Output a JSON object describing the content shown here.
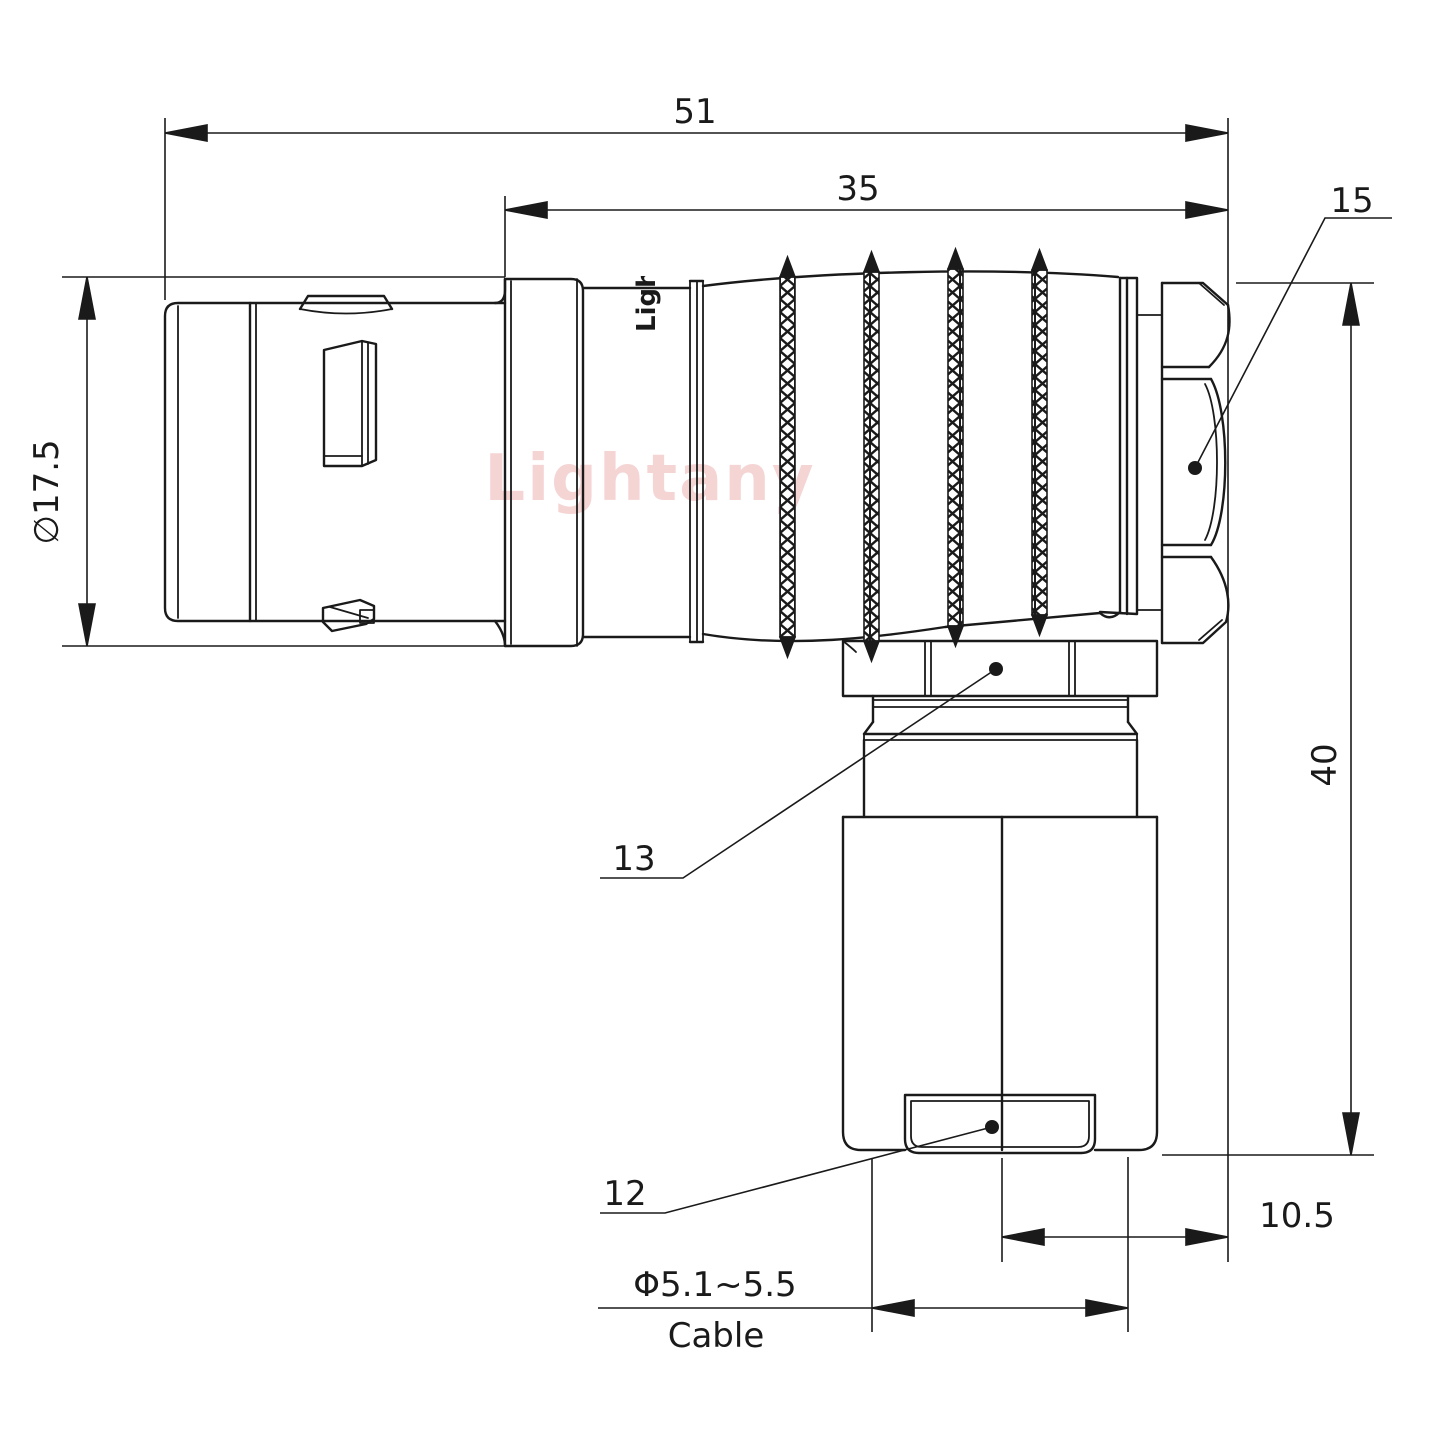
{
  "watermark": {
    "text": "Lightany",
    "color": "#e9a2a2"
  },
  "part_marking": {
    "text": "Lightany"
  },
  "dimensions": {
    "total_length": "51",
    "rear_length": "35",
    "front_diameter": "∅17.5",
    "height": "40",
    "axis_to_face": "10.5",
    "cable_diameter": "Φ5.1~5.5",
    "cable_word": "Cable"
  },
  "part_labels": {
    "backshell_nut": "15",
    "coupling_nut": "13",
    "cable_clamp": "12"
  },
  "colors": {
    "line": "#1a1a1a",
    "background": "#ffffff"
  }
}
